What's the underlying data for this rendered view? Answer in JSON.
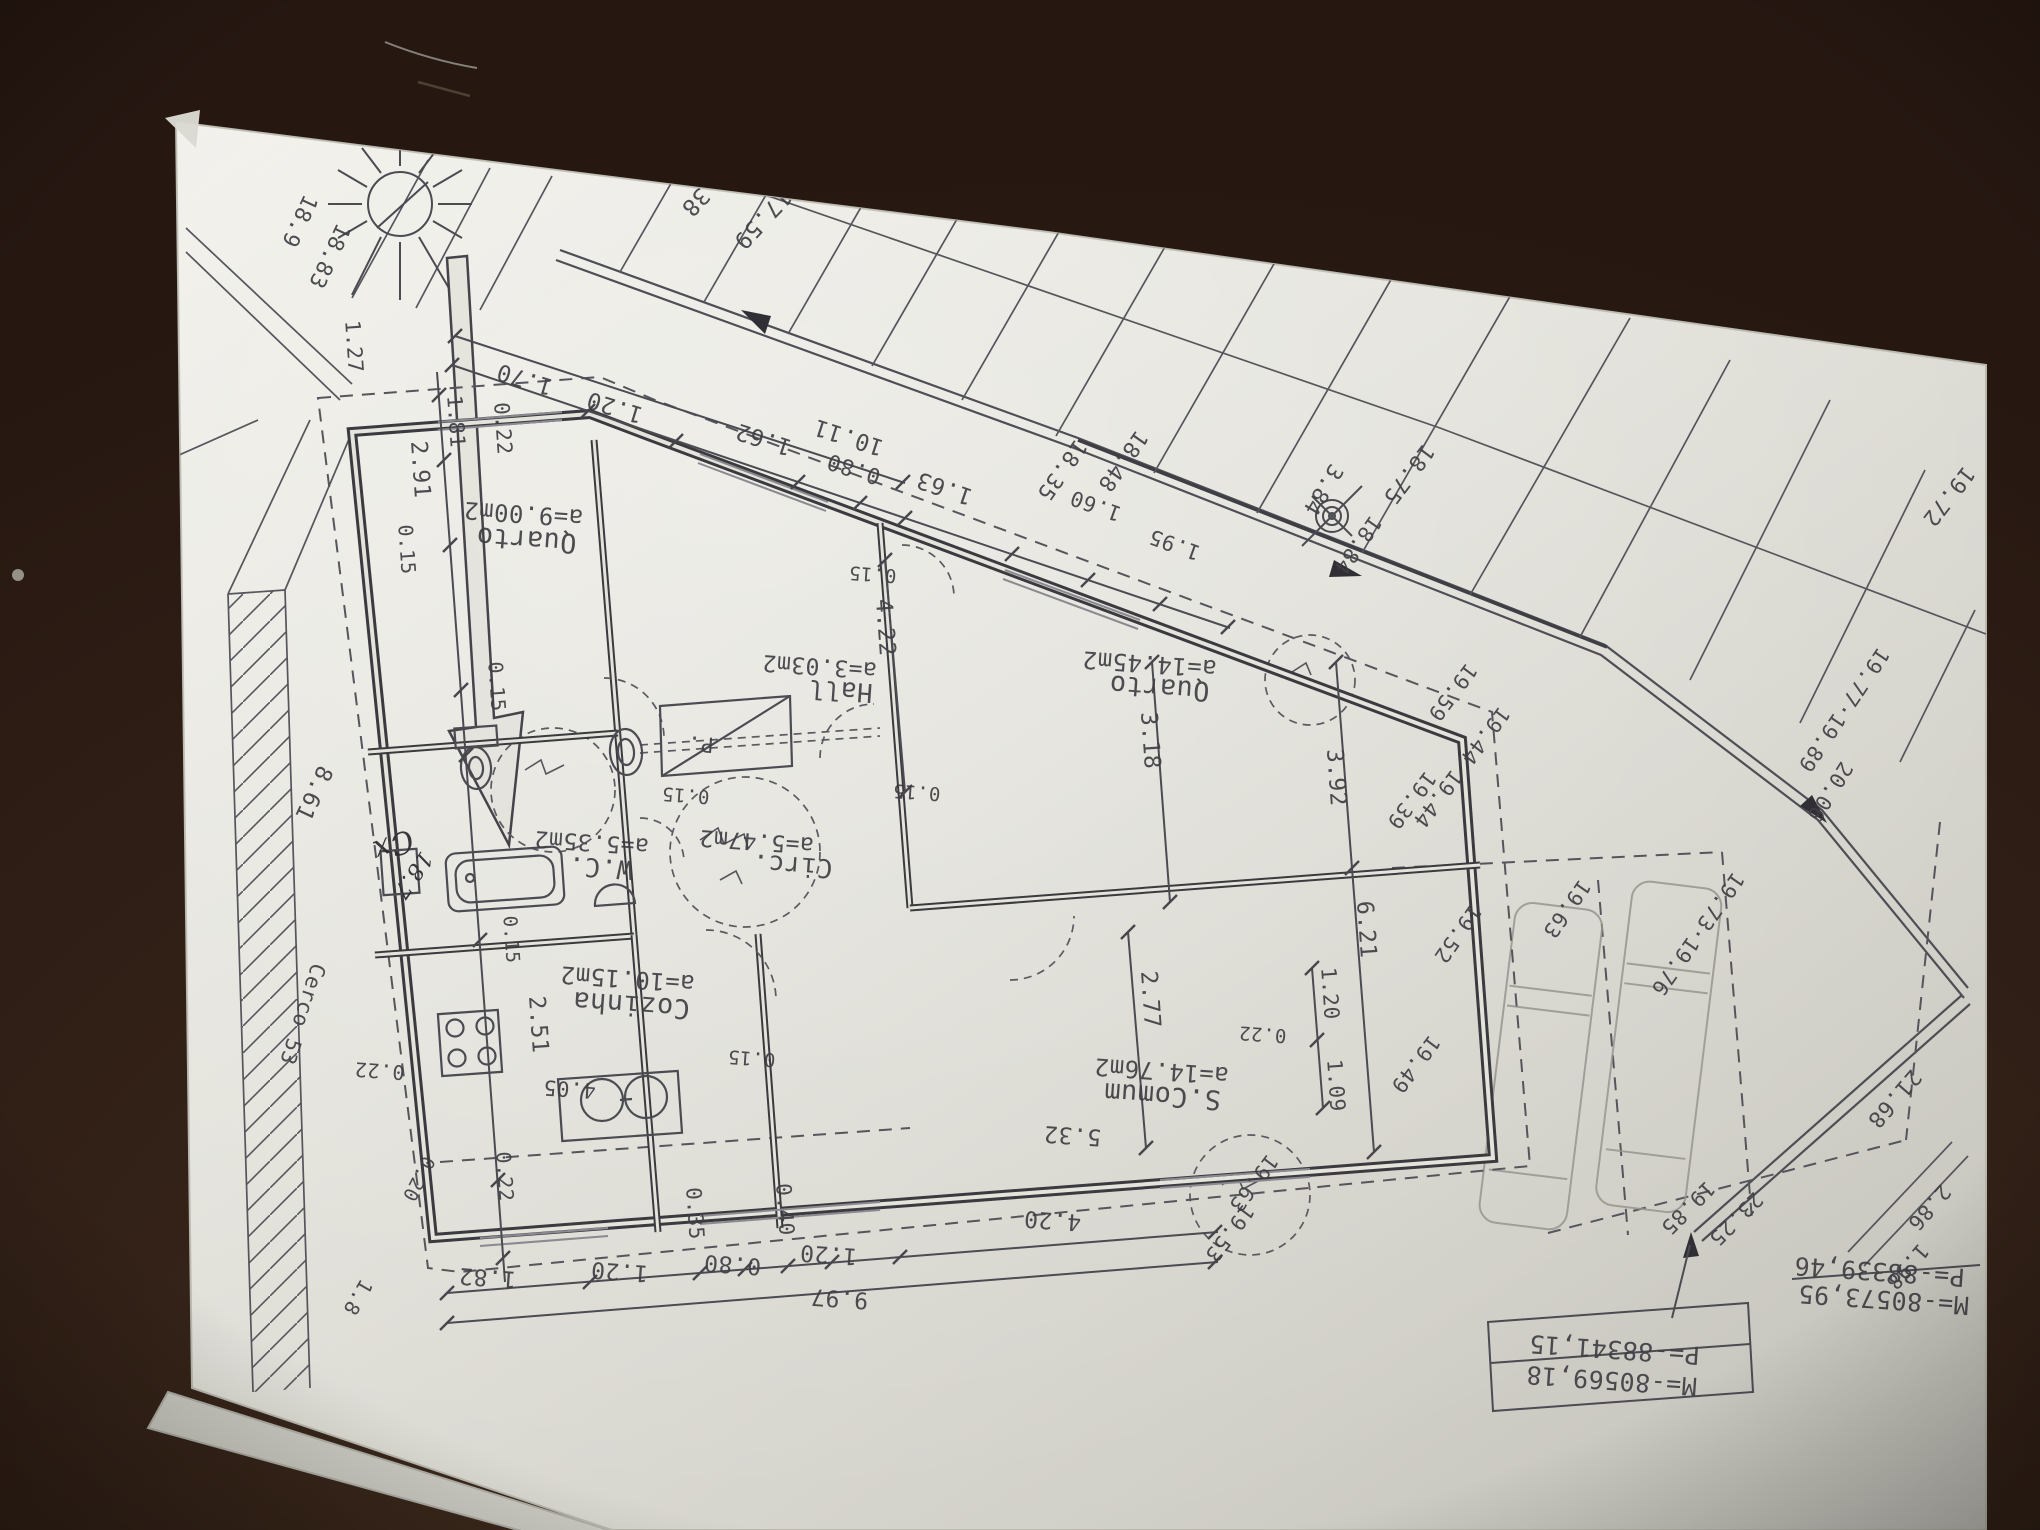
{
  "colors": {
    "wood": "#261711",
    "paper": "#e3e2dc",
    "ink": "#3f3f44",
    "pencil": "#97958f"
  },
  "plan_labels": {
    "rooms": [
      {
        "n": "room-label-quarto1-area",
        "t": "a=9.00m2",
        "x": 524,
        "y": 506,
        "r": 184,
        "s": 24
      },
      {
        "n": "room-label-quarto1",
        "t": "Quarto",
        "x": 527,
        "y": 531,
        "r": 184,
        "s": 27
      },
      {
        "n": "room-label-hall-area",
        "t": "a=3.03m2",
        "x": 820,
        "y": 659,
        "r": 184,
        "s": 23
      },
      {
        "n": "room-label-hall",
        "t": "Hall",
        "x": 841,
        "y": 682,
        "r": 184,
        "s": 26
      },
      {
        "n": "room-label-quarto2-area",
        "t": "a=14.45m2",
        "x": 1150,
        "y": 656,
        "r": 184,
        "s": 24
      },
      {
        "n": "room-label-quarto2",
        "t": "Quarto",
        "x": 1160,
        "y": 679,
        "r": 184,
        "s": 27
      },
      {
        "n": "room-label-wc-area",
        "t": "a=5.35m2",
        "x": 592,
        "y": 835,
        "r": 184,
        "s": 23
      },
      {
        "n": "room-label-wc",
        "t": "W.C.",
        "x": 601,
        "y": 859,
        "r": 184,
        "s": 26
      },
      {
        "n": "room-label-circ-area",
        "t": "a=5.47m2",
        "x": 757,
        "y": 834,
        "r": 184,
        "s": 23
      },
      {
        "n": "room-label-circ",
        "t": "Circ.",
        "x": 793,
        "y": 857,
        "r": 184,
        "s": 26
      },
      {
        "n": "room-label-cozinha-area",
        "t": "a=10.15m2",
        "x": 628,
        "y": 971,
        "r": 184,
        "s": 24
      },
      {
        "n": "room-label-cozinha",
        "t": "Cozinha",
        "x": 632,
        "y": 996,
        "r": 184,
        "s": 27
      },
      {
        "n": "room-label-scomum-area",
        "t": "a=14.76m2",
        "x": 1162,
        "y": 1063,
        "r": 184,
        "s": 24
      },
      {
        "n": "room-label-scomum",
        "t": "S.Comum",
        "x": 1163,
        "y": 1087,
        "r": 184,
        "s": 27
      },
      {
        "n": "room-label-closet",
        "t": "P.",
        "x": 701,
        "y": 737,
        "r": 184,
        "s": 21
      }
    ],
    "top_dimensions": [
      {
        "n": "dim-1-70",
        "t": "1.70",
        "x": 527,
        "y": 372,
        "r": 197,
        "s": 23
      },
      {
        "n": "dim-1-20-a",
        "t": "1.20",
        "x": 617,
        "y": 400,
        "r": 197,
        "s": 23
      },
      {
        "n": "dim-1-62",
        "t": "1.62",
        "x": 766,
        "y": 432,
        "r": 198,
        "s": 23
      },
      {
        "n": "dim-10-11",
        "t": "10.11",
        "x": 851,
        "y": 430,
        "r": 198,
        "s": 23
      },
      {
        "n": "dim-0-80-a",
        "t": "0.80",
        "x": 856,
        "y": 462,
        "r": 198,
        "s": 22
      },
      {
        "n": "dim-1-63",
        "t": "1.63",
        "x": 947,
        "y": 481,
        "r": 199,
        "s": 23
      },
      {
        "n": "dim-1-60",
        "t": "1.60",
        "x": 1098,
        "y": 499,
        "r": 200,
        "s": 21
      },
      {
        "n": "dim-1-95",
        "t": "1.95",
        "x": 1177,
        "y": 538,
        "r": 200,
        "s": 21
      }
    ],
    "site_numbers": [
      {
        "n": "lot-18-35",
        "t": "18.35",
        "x": 1056,
        "y": 466,
        "r": 125,
        "s": 22
      },
      {
        "n": "lot-18-48",
        "t": "18.48",
        "x": 1117,
        "y": 457,
        "r": 125,
        "s": 22
      },
      {
        "n": "dim-3-84",
        "t": "3.84",
        "x": 1317,
        "y": 486,
        "r": 121,
        "s": 22
      },
      {
        "n": "lot-18-75",
        "t": "18.75",
        "x": 1403,
        "y": 470,
        "r": 127,
        "s": 22
      },
      {
        "n": "lot-18-84",
        "t": "18.84",
        "x": 1352,
        "y": 541,
        "r": 125,
        "s": 21
      },
      {
        "n": "lot-38",
        "t": "38",
        "x": 690,
        "y": 197,
        "r": 133,
        "s": 23
      },
      {
        "n": "lot-17-59",
        "t": "17.59",
        "x": 757,
        "y": 214,
        "r": 133,
        "s": 23
      },
      {
        "n": "edge-18-9",
        "t": "18.9",
        "x": 293,
        "y": 218,
        "r": 115,
        "s": 22
      },
      {
        "n": "edge-18-83",
        "t": "18.83",
        "x": 323,
        "y": 253,
        "r": 115,
        "s": 22
      },
      {
        "n": "lot-cerco",
        "t": "Cerco 53",
        "x": 296,
        "y": 1012,
        "r": 108,
        "s": 21
      },
      {
        "n": "dim-8-61",
        "t": "8.61",
        "x": 307,
        "y": 790,
        "r": 115,
        "s": 23
      }
    ],
    "left_dimensions": [
      {
        "n": "dim-1-27",
        "t": "1.27",
        "x": 347,
        "y": 347,
        "r": 86,
        "s": 21
      },
      {
        "n": "dim-0-22-tl",
        "t": "0.22",
        "x": 496,
        "y": 429,
        "r": 86,
        "s": 21
      },
      {
        "n": "dim-1-81-tl",
        "t": "1.81",
        "x": 449,
        "y": 422,
        "r": 86,
        "s": 21
      },
      {
        "n": "dim-2-91",
        "t": "2.91",
        "x": 413,
        "y": 470,
        "r": 86,
        "s": 23
      },
      {
        "n": "dim-0-15-a",
        "t": "0.15",
        "x": 400,
        "y": 550,
        "r": 86,
        "s": 20
      },
      {
        "n": "dim-0-15-b",
        "t": "0.15",
        "x": 490,
        "y": 687,
        "r": 86,
        "s": 20
      },
      {
        "n": "dim-0-22-k",
        "t": "0.22",
        "x": 380,
        "y": 1064,
        "r": 184,
        "s": 20
      },
      {
        "n": "dim-0-20",
        "t": "0.20",
        "x": 413,
        "y": 1176,
        "r": 117,
        "s": 19
      },
      {
        "n": "dim-1-8-bl",
        "t": "1.8",
        "x": 352,
        "y": 1294,
        "r": 120,
        "s": 20
      },
      {
        "n": "dim-0-22-kv",
        "t": "0.22",
        "x": 498,
        "y": 1177,
        "r": 86,
        "s": 20
      }
    ],
    "interior_dimensions": [
      {
        "n": "dim-0-15-c",
        "t": "0.15",
        "x": 873,
        "y": 568,
        "r": 184,
        "s": 19
      },
      {
        "n": "dim-4-22",
        "t": "4.22",
        "x": 878,
        "y": 628,
        "r": 86,
        "s": 23
      },
      {
        "n": "dim-3-18",
        "t": "3.18",
        "x": 1143,
        "y": 741,
        "r": 86,
        "s": 23
      },
      {
        "n": "dim-0-15-d",
        "t": "0.15",
        "x": 686,
        "y": 789,
        "r": 184,
        "s": 19
      },
      {
        "n": "dim-0-15-e",
        "t": "0.15",
        "x": 917,
        "y": 786,
        "r": 184,
        "s": 19
      },
      {
        "n": "dim-0-15-f",
        "t": "0.15",
        "x": 505,
        "y": 940,
        "r": 86,
        "s": 19
      },
      {
        "n": "dim-2-51",
        "t": "2.51",
        "x": 531,
        "y": 1025,
        "r": 86,
        "s": 23
      },
      {
        "n": "dim-0-15-g",
        "t": "0.15",
        "x": 752,
        "y": 1052,
        "r": 184,
        "s": 19
      },
      {
        "n": "dim-4-05",
        "t": "4.05",
        "x": 570,
        "y": 1082,
        "r": 184,
        "s": 21
      },
      {
        "n": "dim-5-32",
        "t": "5.32",
        "x": 1073,
        "y": 1128,
        "r": 184,
        "s": 23
      },
      {
        "n": "dim-2-77",
        "t": "2.77",
        "x": 1143,
        "y": 1000,
        "r": 86,
        "s": 23
      },
      {
        "n": "dim-0-22-r",
        "t": "0.22",
        "x": 1263,
        "y": 1028,
        "r": 184,
        "s": 19
      },
      {
        "n": "dim-1-20-r",
        "t": "1.20",
        "x": 1323,
        "y": 994,
        "r": 86,
        "s": 21
      },
      {
        "n": "dim-1-09",
        "t": "1.09",
        "x": 1329,
        "y": 1086,
        "r": 86,
        "s": 21
      },
      {
        "n": "dim-3-92",
        "t": "3.92",
        "x": 1329,
        "y": 778,
        "r": 86,
        "s": 23
      },
      {
        "n": "dim-6-21",
        "t": "6.21",
        "x": 1359,
        "y": 930,
        "r": 86,
        "s": 23
      }
    ],
    "bottom_dimensions": [
      {
        "n": "dim-1-82",
        "t": "1.82",
        "x": 488,
        "y": 1270,
        "r": 184,
        "s": 23
      },
      {
        "n": "dim-1-20-b",
        "t": "1.20",
        "x": 620,
        "y": 1264,
        "r": 184,
        "s": 23
      },
      {
        "n": "dim-0-35",
        "t": "0.35",
        "x": 688,
        "y": 1214,
        "r": 86,
        "s": 21
      },
      {
        "n": "dim-0-80-b",
        "t": "0.80",
        "x": 733,
        "y": 1257,
        "r": 184,
        "s": 23
      },
      {
        "n": "dim-0-40",
        "t": "0.40",
        "x": 778,
        "y": 1210,
        "r": 86,
        "s": 21
      },
      {
        "n": "dim-1-20-c",
        "t": "1.20",
        "x": 829,
        "y": 1247,
        "r": 184,
        "s": 23
      },
      {
        "n": "dim-4-20",
        "t": "4.20",
        "x": 1053,
        "y": 1213,
        "r": 184,
        "s": 23
      },
      {
        "n": "dim-9-97",
        "t": "9.97",
        "x": 840,
        "y": 1291,
        "r": 184,
        "s": 23
      }
    ],
    "elevations": [
      {
        "n": "elev-19-59",
        "t": "19.59",
        "x": 1447,
        "y": 688,
        "r": 127,
        "s": 21
      },
      {
        "n": "elev-19-44",
        "t": "19.44 19.44",
        "x": 1456,
        "y": 763,
        "r": 127,
        "s": 21
      },
      {
        "n": "elev-19-39",
        "t": "19.39",
        "x": 1406,
        "y": 796,
        "r": 127,
        "s": 21
      },
      {
        "n": "elev-19-52",
        "t": "19.52",
        "x": 1452,
        "y": 930,
        "r": 125,
        "s": 21
      },
      {
        "n": "elev-19-49",
        "t": "19.49",
        "x": 1410,
        "y": 1060,
        "r": 127,
        "s": 21
      },
      {
        "n": "elev-19-63-a",
        "t": "19.63",
        "x": 1561,
        "y": 905,
        "r": 125,
        "s": 21
      },
      {
        "n": "elev-19-73-76",
        "t": "19.73·19.76",
        "x": 1692,
        "y": 930,
        "r": 125,
        "s": 21
      },
      {
        "n": "elev-19-77-89",
        "t": "19.77·19.89",
        "x": 1838,
        "y": 706,
        "r": 124,
        "s": 21
      },
      {
        "n": "elev-20-06",
        "t": "20.06",
        "x": 1824,
        "y": 788,
        "r": 122,
        "s": 21
      },
      {
        "n": "elev-19-72",
        "t": "19.72",
        "x": 1943,
        "y": 492,
        "r": 128,
        "s": 22
      },
      {
        "n": "elev-21-68",
        "t": "21.68",
        "x": 1889,
        "y": 1094,
        "r": 131,
        "s": 22
      },
      {
        "n": "elev-19-85",
        "t": "19.85",
        "x": 1683,
        "y": 1203,
        "r": 135,
        "s": 21
      },
      {
        "n": "elev-23-25",
        "t": "23.25",
        "x": 1731,
        "y": 1214,
        "r": 135,
        "s": 21
      },
      {
        "n": "elev-2-86",
        "t": "2.86",
        "x": 1924,
        "y": 1203,
        "r": 131,
        "s": 21
      },
      {
        "n": "elev-1-98",
        "t": "1.98",
        "x": 1902,
        "y": 1262,
        "r": 131,
        "s": 21
      },
      {
        "n": "elev-19-63-b",
        "t": "19.63",
        "x": 1248,
        "y": 1179,
        "r": 127,
        "s": 21
      },
      {
        "n": "elev-19-53",
        "t": "19.53",
        "x": 1224,
        "y": 1229,
        "r": 127,
        "s": 21
      }
    ],
    "survey_coordinates": [
      {
        "n": "coord-m-right",
        "t": "M=-80573,95",
        "x": 1884,
        "y": 1291,
        "r": 184,
        "s": 25
      },
      {
        "n": "coord-p-right",
        "t": "P=-88339,46",
        "x": 1880,
        "y": 1263,
        "r": 184,
        "s": 25
      },
      {
        "n": "coord-m-left",
        "t": "M=-80569,18",
        "x": 1612,
        "y": 1372,
        "r": 184,
        "s": 25
      },
      {
        "n": "coord-p-left",
        "t": "P=-88341,15",
        "x": 1615,
        "y": 1341,
        "r": 184,
        "s": 25
      }
    ],
    "annotations": [
      {
        "n": "hand-cx",
        "t": "Cx",
        "x": 390,
        "y": 836,
        "r": 160,
        "s": 30,
        "c": "hand"
      },
      {
        "n": "hand-18-7",
        "t": "18.7",
        "x": 407,
        "y": 871,
        "r": 125,
        "s": 22,
        "c": "hand"
      }
    ]
  }
}
